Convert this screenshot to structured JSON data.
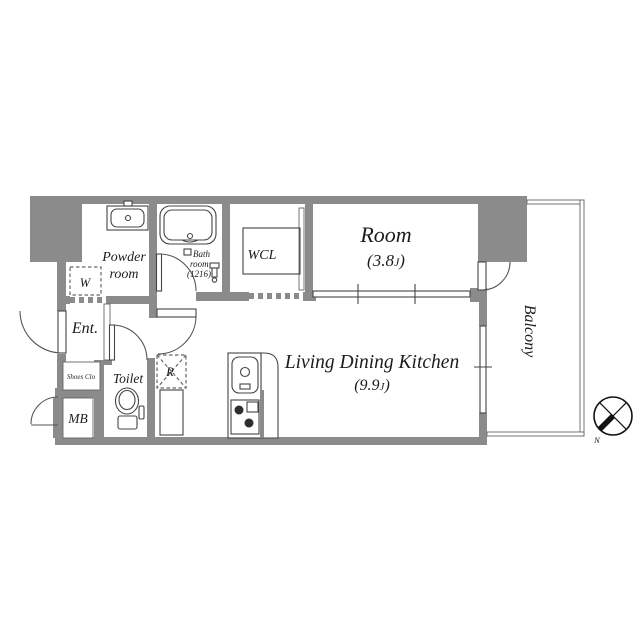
{
  "plan": {
    "rooms": {
      "powder_room": {
        "line1": "Powder",
        "line2": "room"
      },
      "bath_room": {
        "line1": "Bath",
        "line2": "room",
        "line3": "(1216)"
      },
      "wcl": {
        "label": "WCL"
      },
      "bedroom": {
        "label": "Room",
        "area_prefix": "(3.8",
        "area_unit": "J",
        "area_suffix": ")"
      },
      "ldk": {
        "label": "Living Dining Kitchen",
        "area_prefix": "(9.9",
        "area_unit": "J",
        "area_suffix": ")"
      },
      "balcony": {
        "label": "Balcony"
      },
      "entrance": {
        "label": "Ent."
      },
      "shoes_closet": {
        "label": "Shoes Clo"
      },
      "toilet": {
        "label": "Toilet"
      },
      "meter_box": {
        "label": "MB"
      },
      "washing_machine": {
        "label": "W"
      },
      "refrigerator": {
        "label": "R"
      }
    },
    "compass": {
      "north_label": "N"
    },
    "colors": {
      "wall": "#8b8b8b",
      "line": "#444444",
      "background": "#ffffff"
    }
  }
}
